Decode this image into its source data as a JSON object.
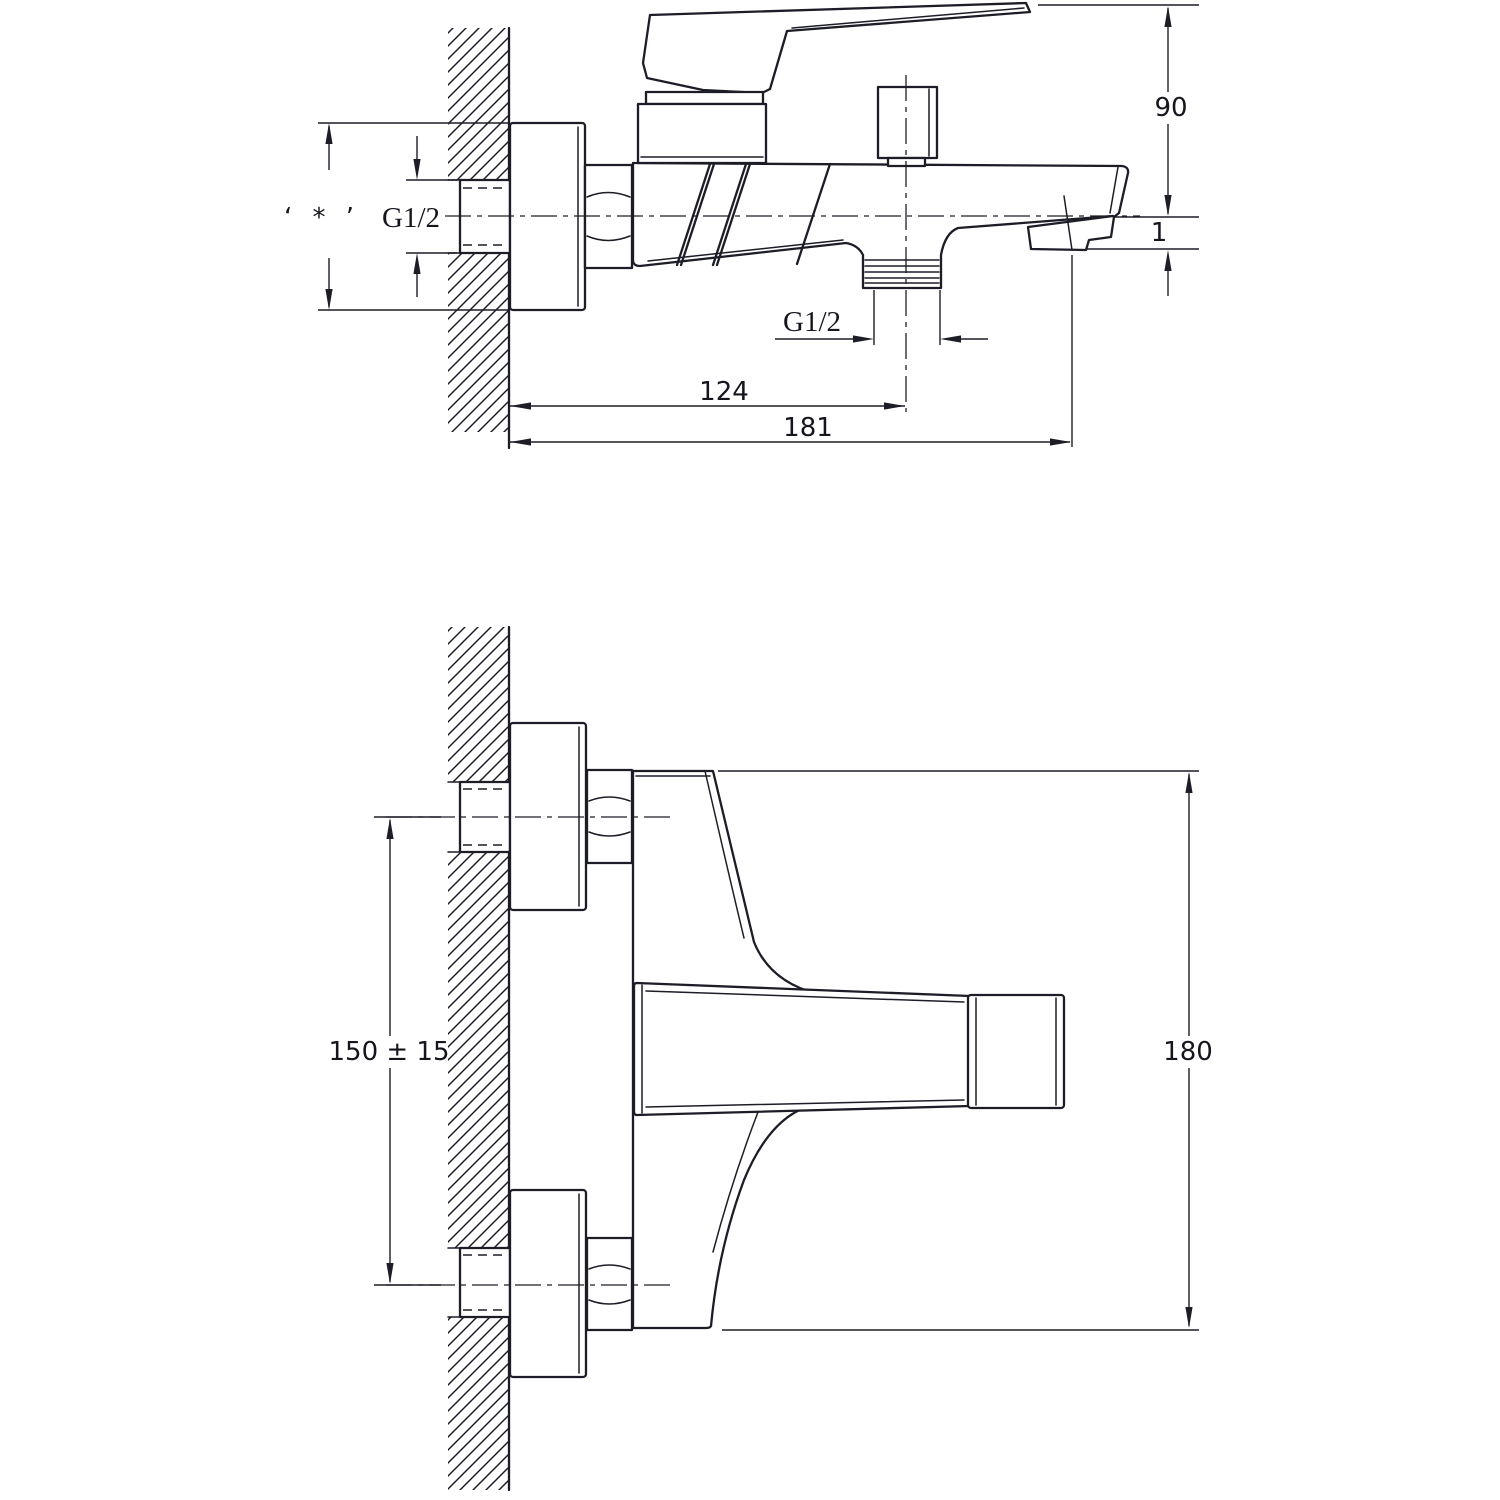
{
  "drawing": {
    "side_view": {
      "mount_note": "‘ * ’",
      "wall_thread_label": "G1/2",
      "outlet_thread_label": "G1/2",
      "dim_spout_height": "90",
      "dim_spout_drop": "1",
      "dim_wall_to_outlet": "124",
      "dim_wall_to_spout_tip": "181"
    },
    "front_view": {
      "dim_inlet_spacing": "150 ± 15",
      "dim_overall_height": "180"
    }
  }
}
